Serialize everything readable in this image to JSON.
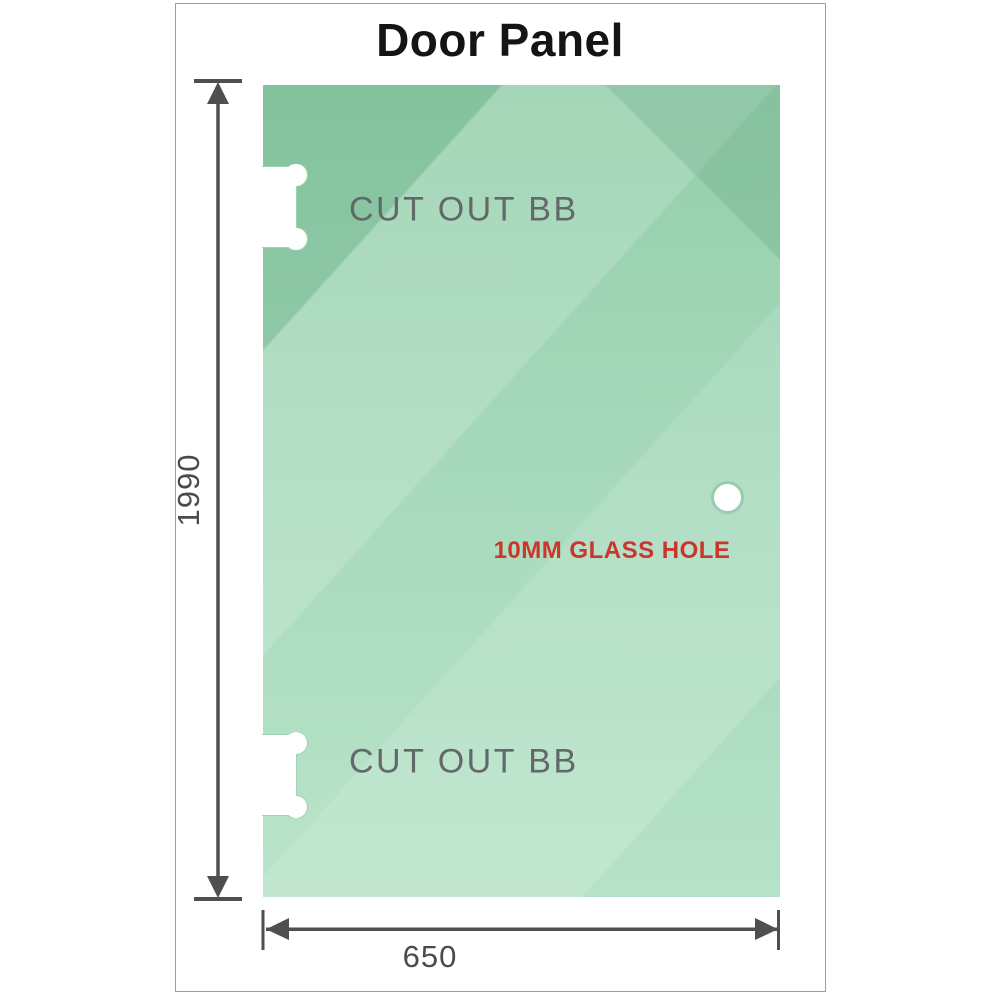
{
  "title": "Door Panel",
  "panel": {
    "cutouts": [
      {
        "label": "CUT OUT BB"
      },
      {
        "label": "CUT OUT BB"
      }
    ],
    "hole_label": "10MM GLASS HOLE",
    "dimensions": {
      "height": "1990",
      "width": "650"
    }
  },
  "colors": {
    "glass_base": "#8ecca6",
    "glass_light": "#b6e2c7",
    "cutout_outline": "#9ed3b6",
    "dimension_arrow": "#4f4f4f",
    "hole_label_red": "#cb352c",
    "cutout_label_gray": "#63686a",
    "frame_border": "#9e9e9e",
    "title_color": "#141414"
  }
}
